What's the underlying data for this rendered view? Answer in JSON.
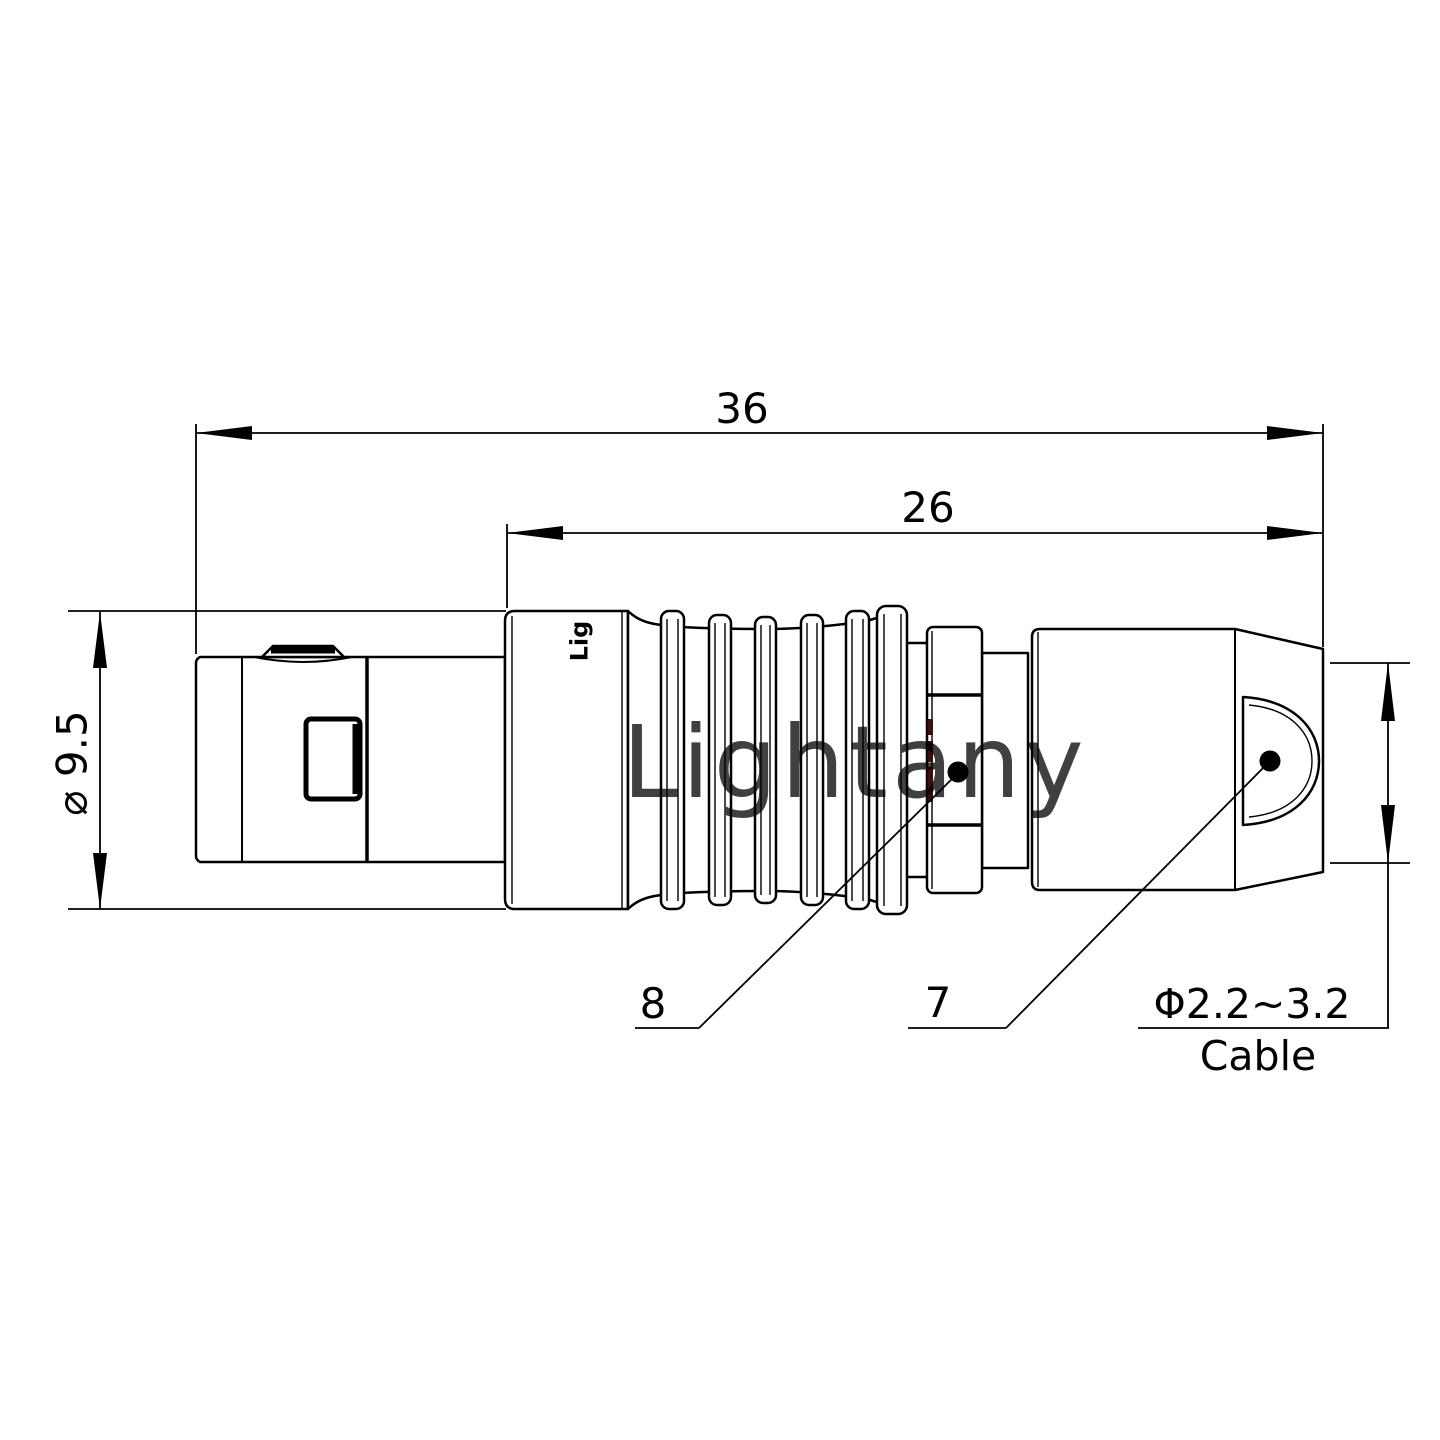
{
  "title": "push-pull-connector-technical-drawing",
  "colors": {
    "background": "#ffffff",
    "line": "#000000",
    "watermark": "#eeb2b2",
    "collar_marks": "#3d1010"
  },
  "watermark": {
    "text": "Lightany"
  },
  "engraving": {
    "text": "Lig"
  },
  "dimensions": {
    "overall_length": "36",
    "rear_length": "26",
    "body_diameter": "⌀ 9.5",
    "cable_range": "Φ2.2~3.2",
    "cable_label": "Cable"
  },
  "callouts": {
    "collar": "8",
    "nut": "7"
  }
}
